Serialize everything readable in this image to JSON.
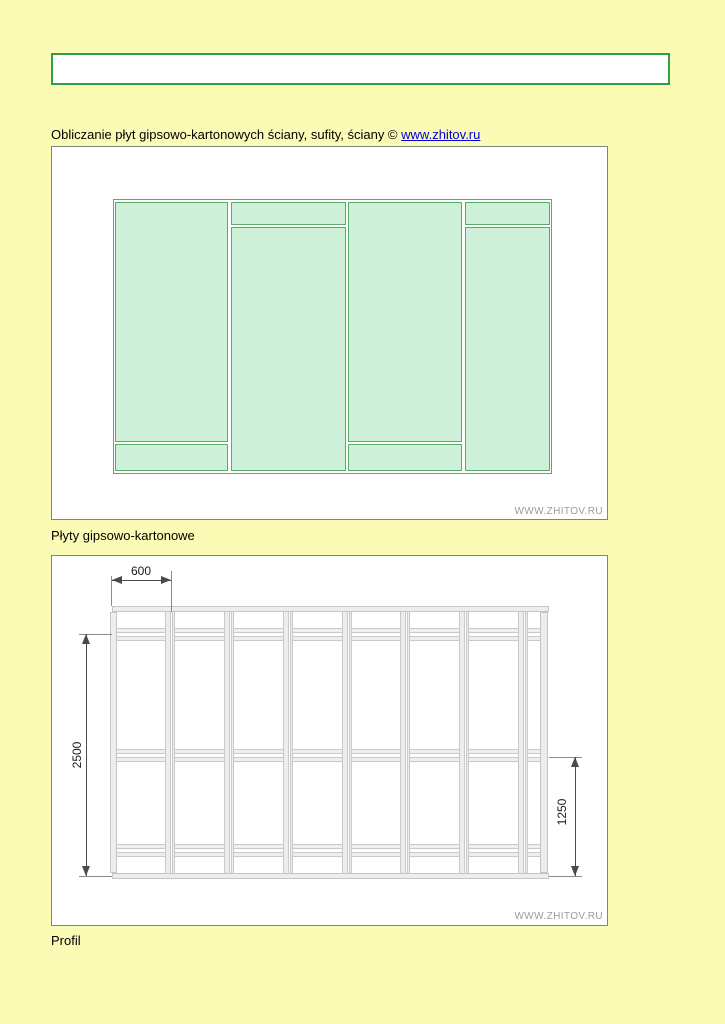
{
  "header": {
    "title": "Obliczanie płyt gipsowo-kartonowych ściany, sufity, ściany ©",
    "link": "www.zhitov.ru"
  },
  "sheets_diagram": {
    "label": "Płyty gipsowo-kartonowe",
    "watermark": "WWW.ZHITOV.RU",
    "layout": {
      "columns": 4,
      "horizontal_joint_position_per_column": [
        "near-bottom",
        "near-top",
        "near-bottom",
        "near-top"
      ]
    }
  },
  "profile_diagram": {
    "label": "Profil",
    "watermark": "WWW.ZHITOV.RU",
    "dims": {
      "stud_spacing": "600",
      "wall_height": "2500",
      "lower_joint_height": "1250"
    },
    "interior_studs": 7,
    "noggin_rows": 3
  },
  "colors": {
    "page_background": "#FBFBB5",
    "banner_border": "#2FA047",
    "sheet_border": "#57AD68",
    "sheet_fill": "#CDF0D9",
    "panel_border": "#828282",
    "link": "#0000DD",
    "watermark": "#9B9B9B"
  }
}
